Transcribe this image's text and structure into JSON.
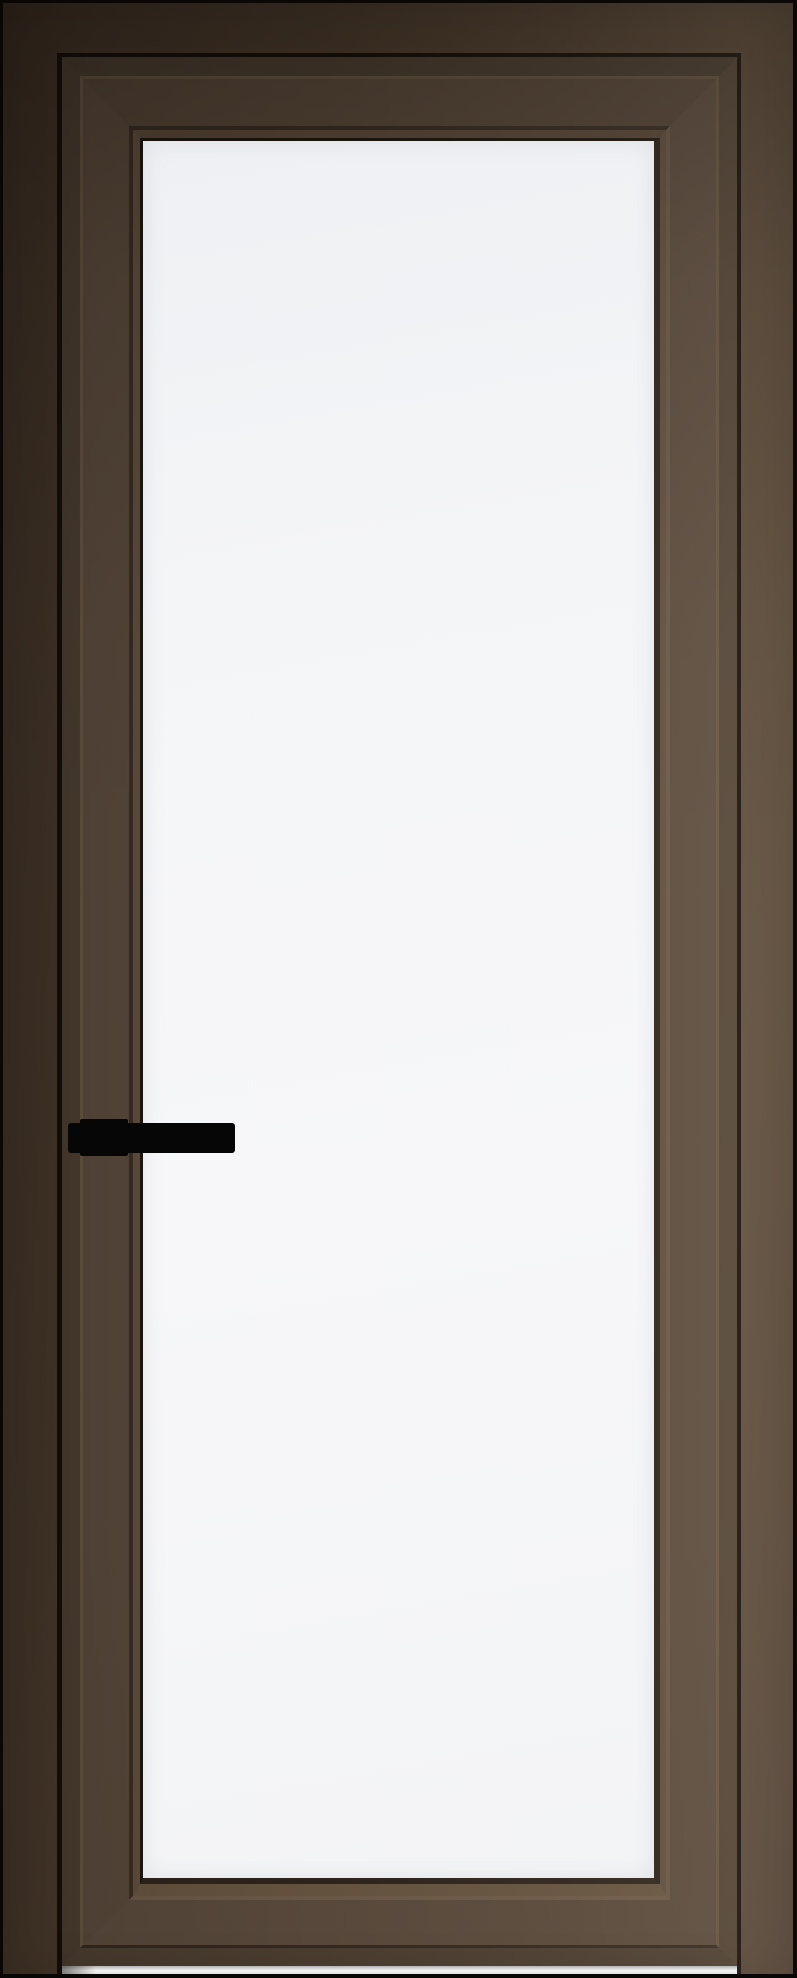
{
  "scene": {
    "type": "product-photo",
    "subject": "Tall interior door with dark bronze aluminum profile frame and white translucent glass panel",
    "door_label": "Glass door: dark bronze frame, full-height white glass insert, black lever handle on left side",
    "handle_label": "Black rectangular lever handle on square mounting plate",
    "glass_label": "White translucent glass panel",
    "frame_label": "Dark bronze door jamb and leaf profile",
    "floor_label": "Light floor gap under door leaf"
  },
  "colors": {
    "frame-dark": "#3e3126",
    "frame-mid": "#4a3b2d",
    "frame-light": "#5b4b3b",
    "gap-black": "#120d09",
    "leaf-edge": "#493c30",
    "leaf-bevel-light": "#60513f",
    "leaf-bevel-dark": "#332921",
    "leaf-face": "#56473a",
    "groove-dark": "#392d23",
    "groove-light": "#675645",
    "bead-face": "#5d4d3e",
    "glass-line": "#1d160f",
    "glass-top": "#eef0f3",
    "glass-mid": "#f7f7f9",
    "glass-bottom": "#f3f4f6",
    "handle-black": "#060606",
    "floor-white": "#fdfdfd",
    "base-black": "#090807"
  }
}
